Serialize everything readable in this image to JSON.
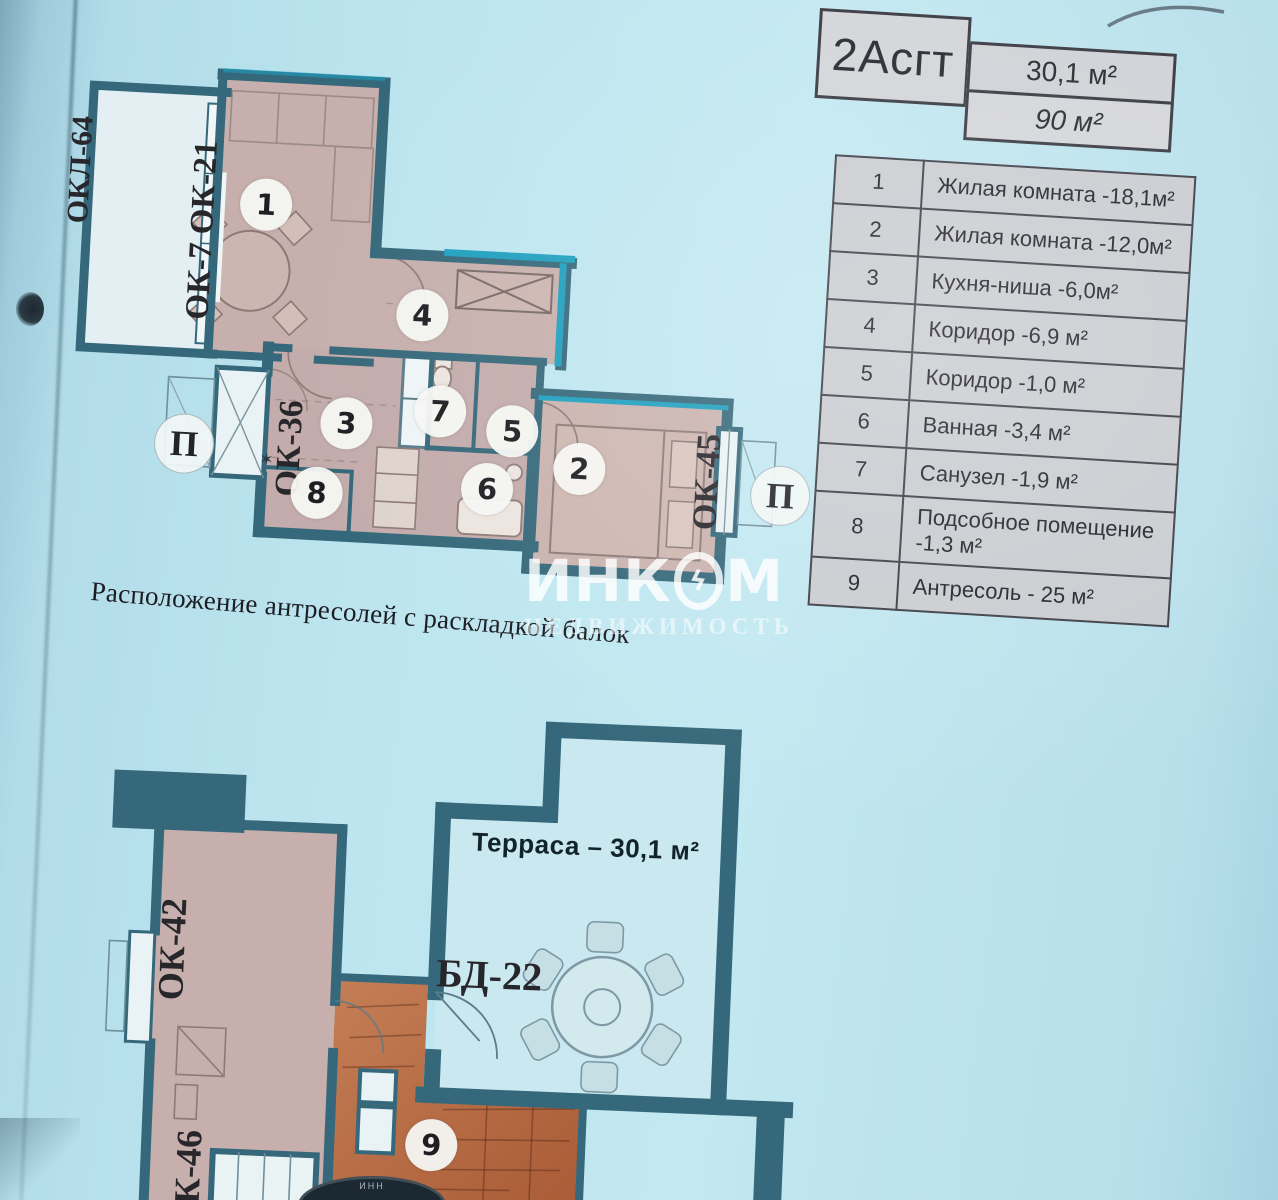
{
  "header": {
    "type_label": "2Асгт",
    "area_top": "30,1 м²",
    "area_bottom": "90 м²"
  },
  "legend": {
    "rows": [
      {
        "num": "1",
        "label": "Жилая комната -18,1м²"
      },
      {
        "num": "2",
        "label": "Жилая комната -12,0м²"
      },
      {
        "num": "3",
        "label": "Кухня-ниша -6,0м²"
      },
      {
        "num": "4",
        "label": "Коридор -6,9 м²"
      },
      {
        "num": "5",
        "label": "Коридор -1,0 м²"
      },
      {
        "num": "6",
        "label": "Ванная -3,4 м²"
      },
      {
        "num": "7",
        "label": "Санузел -1,9 м²"
      },
      {
        "num": "8",
        "label": "Подсобное помещение -1,3 м²"
      },
      {
        "num": "9",
        "label": "Антресоль -  25  м²"
      }
    ]
  },
  "upper_plan": {
    "okl_64": "ОКЛ-64",
    "ok7_ok21": "ОК-7 ОК-21",
    "ok_36": "ОК-36",
    "ok_45": "ОК-45",
    "p_left": "П",
    "p_right": "П",
    "star": "✶",
    "circles": {
      "c1": "1",
      "c2": "2",
      "c3": "3",
      "c4": "4",
      "c5": "5",
      "c6": "6",
      "c7": "7",
      "c8": "8"
    }
  },
  "caption": "Расположение антресолей с раскладкой балок",
  "watermark": {
    "part1": "ИНК",
    "part2": "М",
    "line2": "НЕДВИЖИМОСТЬ"
  },
  "icons": {
    "watermark_bolt": "ϟ"
  },
  "lower_plan": {
    "terrace_label": "Терраса – 30,1 м²",
    "bd_22": "БД-22",
    "ok_42": "ОК-42",
    "k_46": "К-46",
    "circle9": "9",
    "stamp_text": "ИНН"
  },
  "colors": {
    "paper": "#bce5ef",
    "wall": "#35687a",
    "wall_bright": "#1f9fbe",
    "room_pink": "#c5aeab",
    "room_orange": "#bf7550",
    "table_fill": "#c9cbd0"
  }
}
